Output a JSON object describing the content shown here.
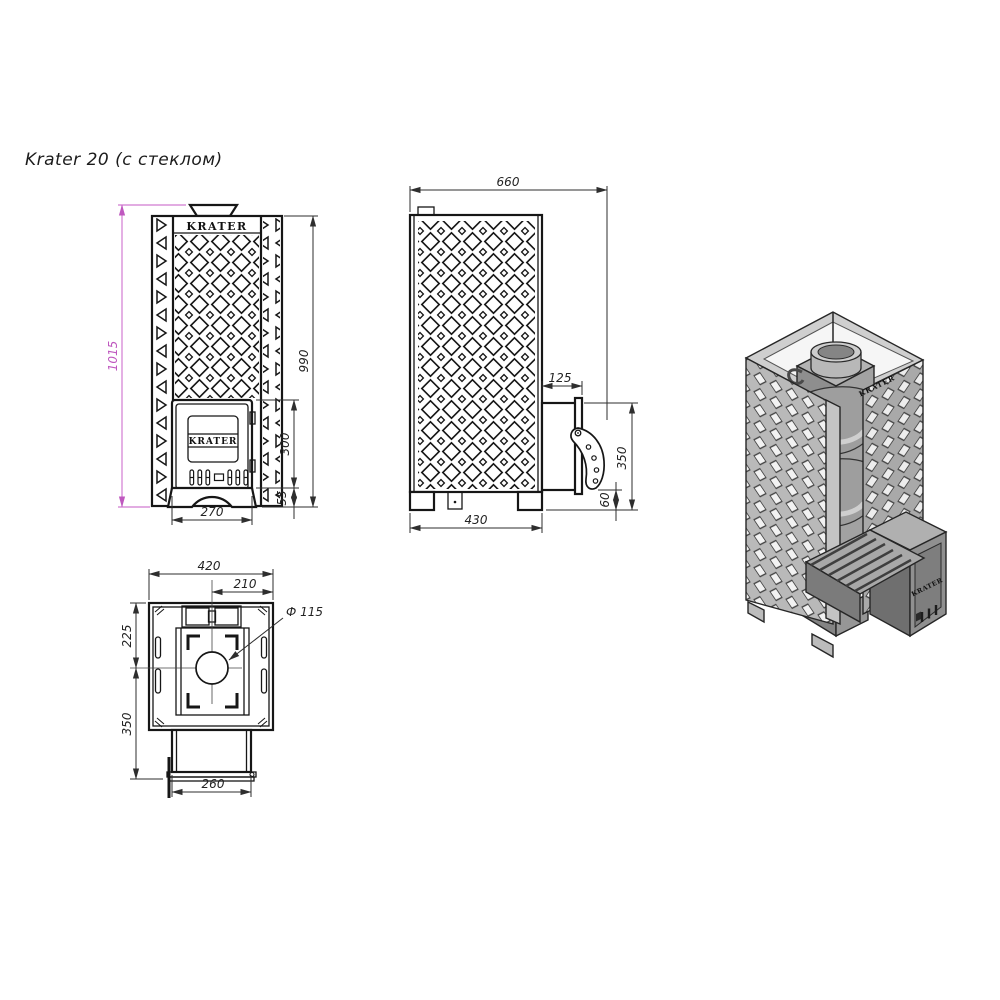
{
  "title": "Krater 20 (с стеклом)",
  "colors": {
    "object_line": "#161616",
    "dimension_line": "#2e2e2e",
    "highlight_dimension": "#bf58bf",
    "iso_light": "#cfcfcf",
    "iso_mid": "#a8a8a8",
    "iso_dark": "#7b7b7b"
  },
  "front_view": {
    "top_logo": "KRATER",
    "door_logo": "KRATER",
    "dim_total_height": "1015",
    "dim_body_height": "990",
    "dim_door_height": "300",
    "dim_base_height": "55",
    "dim_door_width": "270"
  },
  "side_view": {
    "dim_total_depth": "660",
    "dim_tunnel_protrusion": "125",
    "dim_tunnel_height": "350",
    "dim_handle_clearance": "60",
    "dim_base_depth": "430"
  },
  "top_view": {
    "dim_total_width": "420",
    "dim_chimney_offset": "210",
    "dim_chimney_diameter": "Ф 115",
    "dim_back_to_center": "225",
    "dim_center_to_front": "350",
    "dim_tunnel_width": "260"
  },
  "iso_view": {
    "rim_logo": "KRATER",
    "door_logo": "KRATER"
  }
}
